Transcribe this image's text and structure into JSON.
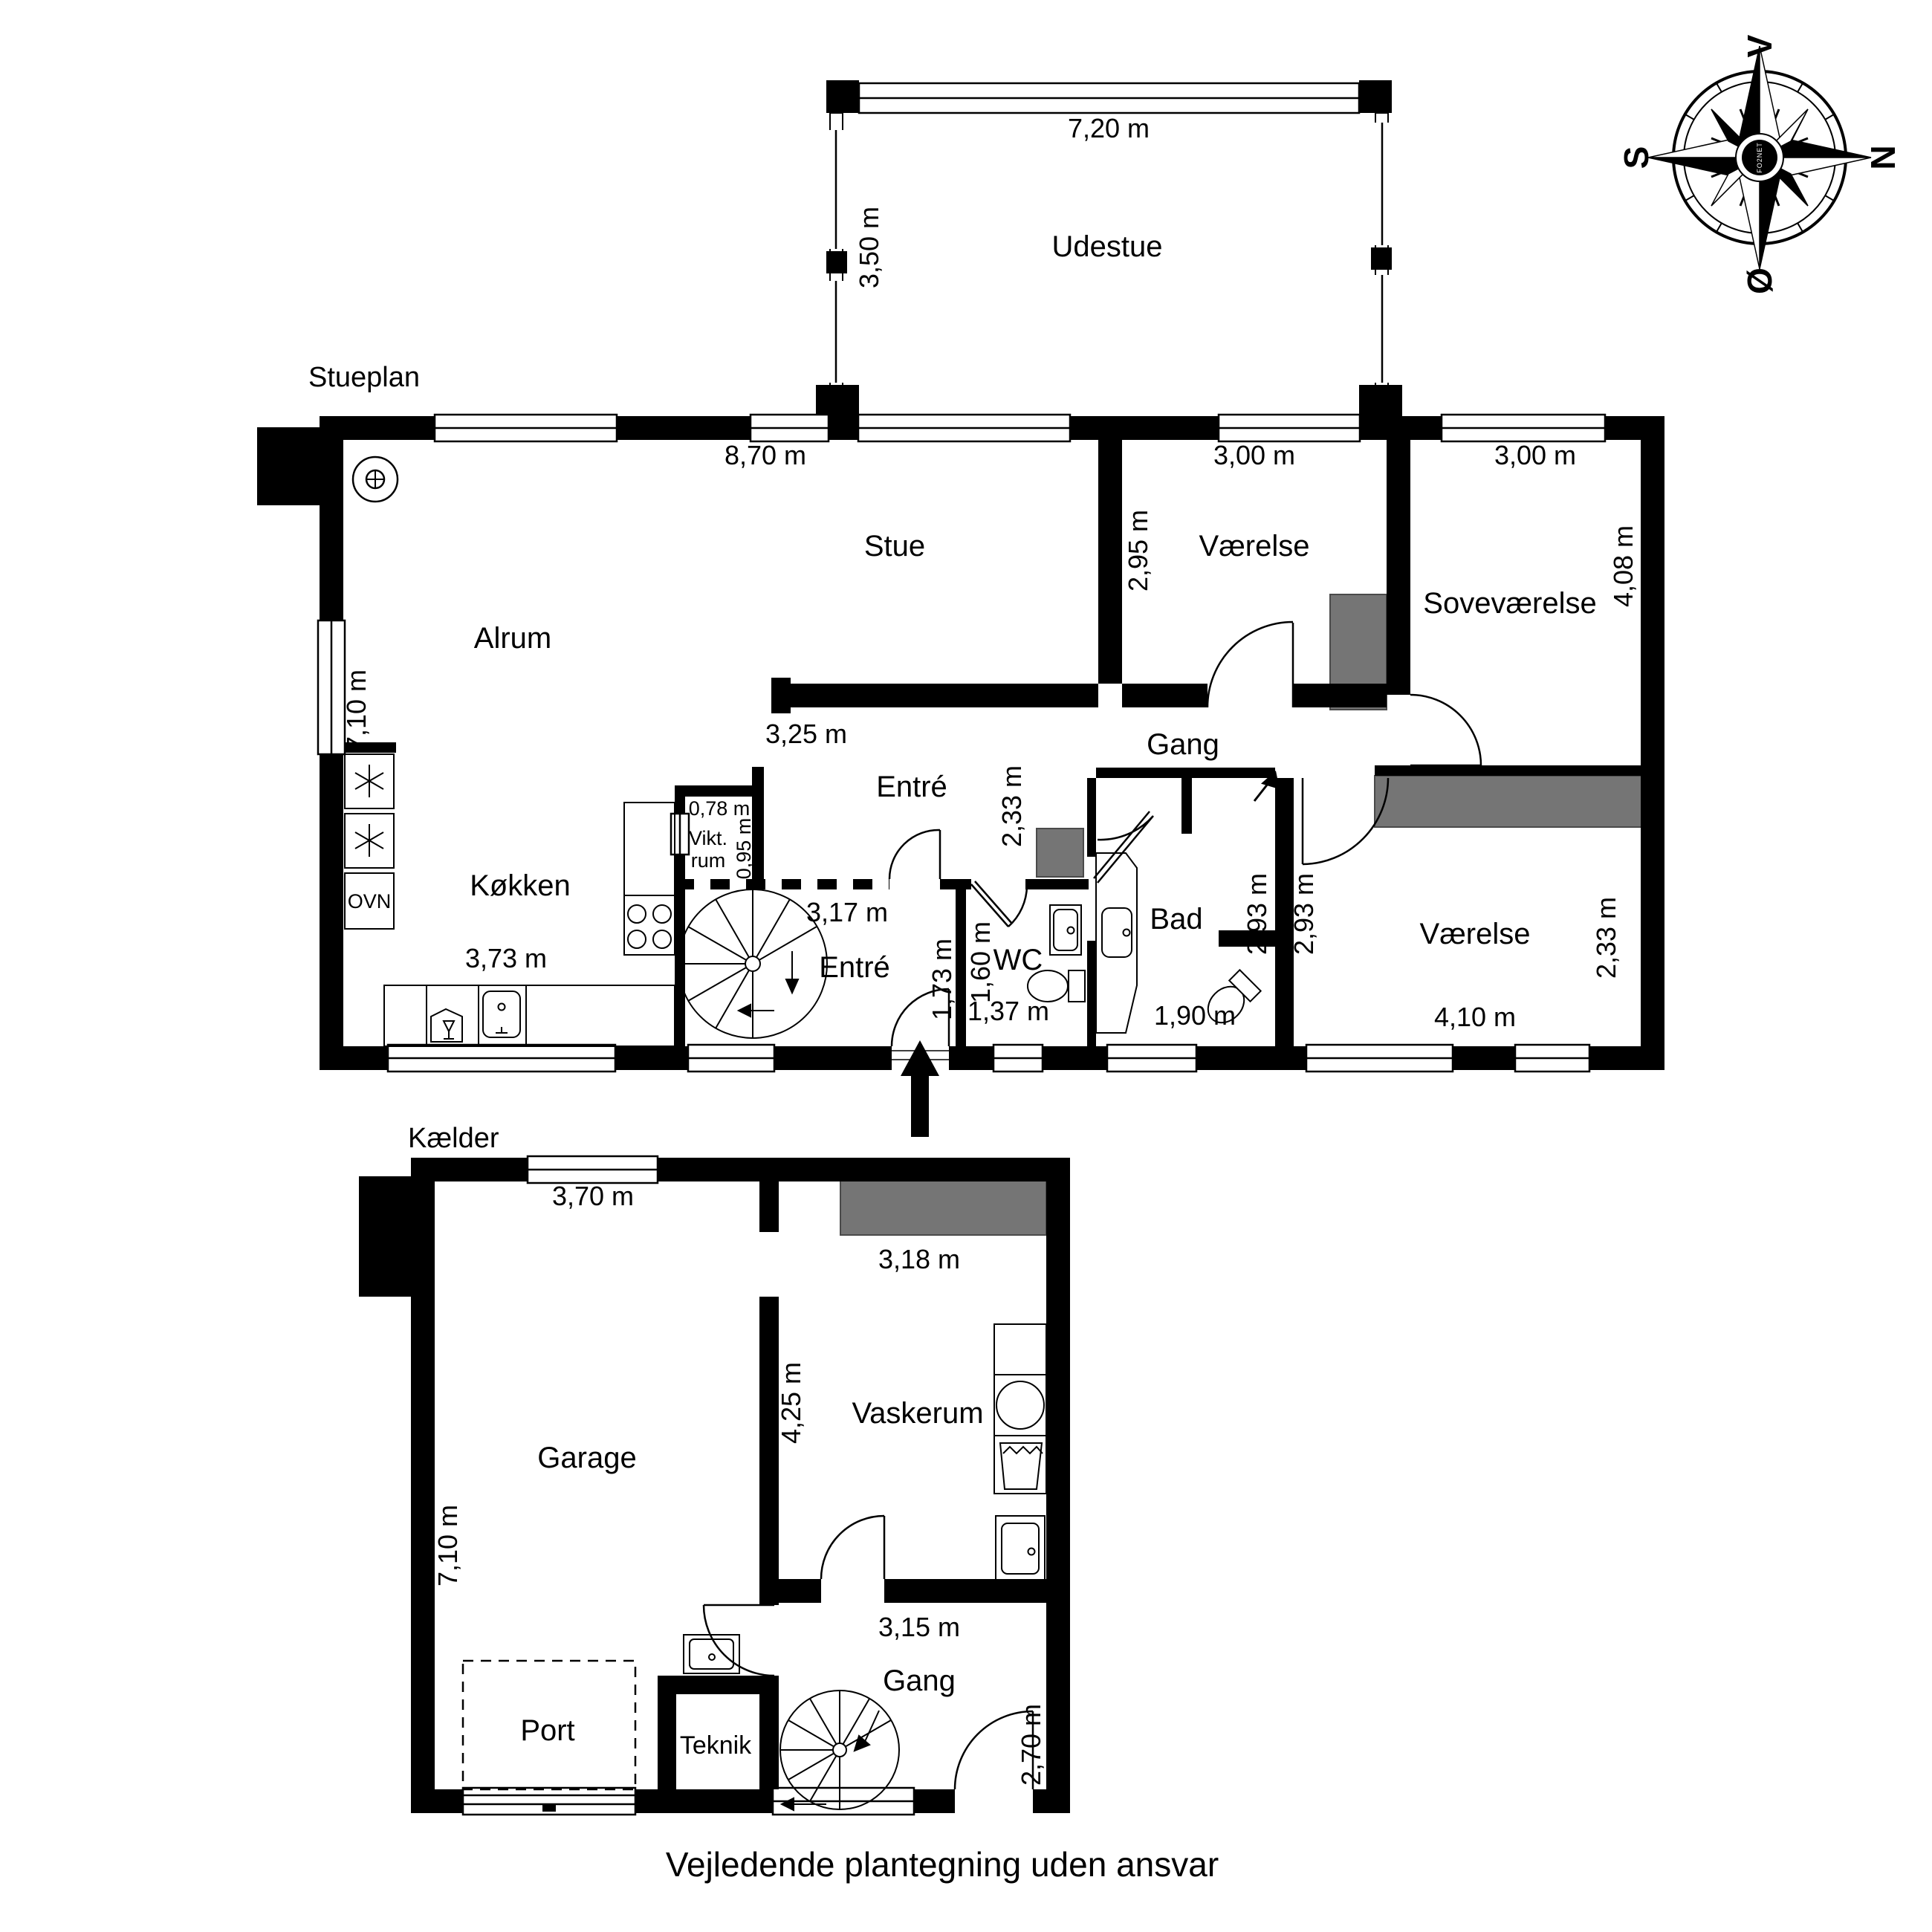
{
  "page": {
    "footer": "Vejledende plantegning uden ansvar",
    "wall_color": "#000000",
    "furniture_gray": "#757575",
    "background": "#ffffff"
  },
  "compass": {
    "west": "V",
    "north": "N",
    "south": "S",
    "east": "Ø",
    "watermark": "FO2NET"
  },
  "stueplan": {
    "title": "Stueplan",
    "rooms": {
      "udestue": "Udestue",
      "stue": "Stue",
      "alrum": "Alrum",
      "vaerelse_nord": "Værelse",
      "sovevaerelse": "Soveværelse",
      "gang": "Gang",
      "entre_upper": "Entré",
      "entre_lower": "Entré",
      "koekken": "Køkken",
      "ovn": "OVN",
      "vikt_line1": "Vikt.",
      "vikt_line2": "rum",
      "wc": "WC",
      "bad": "Bad",
      "vaerelse_syd": "Værelse"
    },
    "dims": {
      "udestue_width": "7,20 m",
      "udestue_depth": "3,50 m",
      "stue_width": "8,70 m",
      "alrum_height": "7,10 m",
      "vaerelse_nord_width": "3,00 m",
      "vaerelse_nord_height": "2,95 m",
      "sovevaerelse_width": "3,00 m",
      "sovevaerelse_height": "4,08 m",
      "stue_syd_width": "3,25 m",
      "entre_upper_height": "2,33 m",
      "koekken_width": "3,73 m",
      "vikt_width": "0,78 m",
      "vikt_height": "0,95 m",
      "entre_width": "3,17 m",
      "entre_niche": "1,73 m",
      "wc_height": "1,60 m",
      "wc_width": "1,37 m",
      "bad_width": "1,90 m",
      "bad_height": "2,93 m",
      "vaerelse_syd_neck": "2,93 m",
      "vaerelse_syd_width": "4,10 m",
      "vaerelse_syd_height": "2,33 m"
    }
  },
  "kaelder": {
    "title": "Kælder",
    "rooms": {
      "garage": "Garage",
      "vaskerum": "Vaskerum",
      "gang": "Gang",
      "teknik": "Teknik",
      "port": "Port"
    },
    "dims": {
      "garage_width": "3,70 m",
      "garage_height": "7,10 m",
      "vaskerum_width": "3,18 m",
      "vaskerum_height": "4,25 m",
      "gang_width": "3,15 m",
      "gang_height": "2,70 m"
    }
  }
}
